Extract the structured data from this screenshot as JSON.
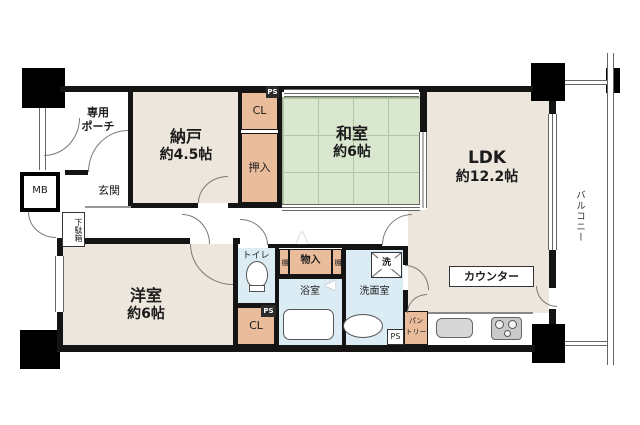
{
  "rooms": {
    "porch": {
      "line1": "専用",
      "line2": "ポーチ"
    },
    "nando": {
      "name": "納戸",
      "size": "約4.5帖"
    },
    "washitsu": {
      "name": "和室",
      "size": "約6帖"
    },
    "ldk": {
      "name": "LDK",
      "size": "約12.2帖"
    },
    "yoshitsu": {
      "name": "洋室",
      "size": "約6帖"
    },
    "genkan": "玄関",
    "toilet": "トイレ",
    "bathroom": "浴室",
    "washroom": "洗面室",
    "balcony": "バルコニー"
  },
  "storage": {
    "cl_upper": "CL",
    "oshiire": "押入",
    "cl_lower": "CL",
    "monoire": "物入",
    "shelf_left": "棚",
    "shelf_right": "棚",
    "pantry_line1": "パン",
    "pantry_line2": "トリー",
    "getabako": "下駄箱"
  },
  "fixtures": {
    "mb": "MB",
    "counter": "カウンター",
    "laundry": "洗",
    "ps_top": "PS",
    "ps_toilet": "PS",
    "ps_kitchen": "PS"
  },
  "colors": {
    "room_beige": "#ece6dc",
    "tatami_green": "#d9e7cf",
    "storage_salmon": "#e9bd9b",
    "wet_blue": "#dcecf5",
    "wall_black": "#141414"
  }
}
